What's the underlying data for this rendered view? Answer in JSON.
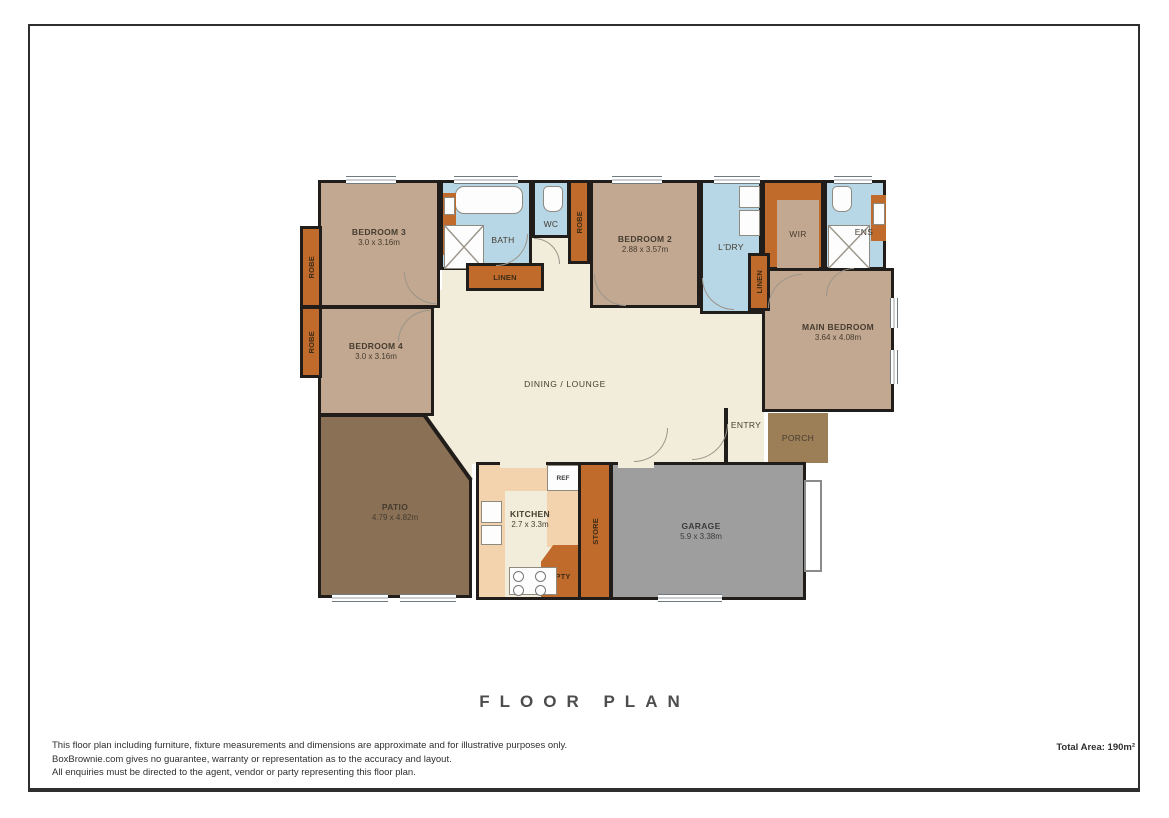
{
  "page": {
    "title": "FLOOR PLAN",
    "footer": {
      "disclaimer_line1": "This floor plan including furniture, fixture measurements and dimensions are approximate and for illustrative purposes only.",
      "disclaimer_line2": "BoxBrownie.com gives no guarantee, warranty or representation as to the accuracy and layout.",
      "disclaimer_line3": "All enquiries must be directed to the agent, vendor or party representing this floor plan.",
      "total_area": "Total Area: 190m²"
    }
  },
  "rooms": {
    "bedroom3": {
      "label": "BEDROOM 3",
      "dims": "3.0 x 3.16m"
    },
    "bedroom4": {
      "label": "BEDROOM 4",
      "dims": "3.0 x 3.16m"
    },
    "bedroom2": {
      "label": "BEDROOM 2",
      "dims": "2.88 x 3.57m"
    },
    "main_bedroom": {
      "label": "MAIN BEDROOM",
      "dims": "3.64 x 4.08m"
    },
    "bath": {
      "label": "BATH"
    },
    "wc": {
      "label": "WC"
    },
    "laundry": {
      "label": "L'DRY"
    },
    "wir": {
      "label": "WIR"
    },
    "ensuite": {
      "label": "ENS"
    },
    "dining_lounge": {
      "label": "DINING / LOUNGE"
    },
    "entry": {
      "label": "ENTRY"
    },
    "porch": {
      "label": "PORCH"
    },
    "patio": {
      "label": "PATIO",
      "dims": "4.79 x 4.82m"
    },
    "kitchen": {
      "label": "KITCHEN",
      "dims": "2.7 x 3.3m"
    },
    "garage": {
      "label": "GARAGE",
      "dims": "5.9 x 3.38m"
    },
    "linen_hall": {
      "label": "LINEN"
    },
    "linen_main": {
      "label": "LINEN"
    },
    "robe_bed3": {
      "label": "ROBE"
    },
    "robe_bed4": {
      "label": "ROBE"
    },
    "robe_bed2": {
      "label": "ROBE"
    },
    "fridge": {
      "label": "REF"
    },
    "store": {
      "label": "STORE"
    },
    "pantry": {
      "label": "PTY"
    }
  },
  "colors": {
    "wall": "#211d1a",
    "tan": "#c2a890",
    "blue": "#b7d6e6",
    "cream": "#f2ecda",
    "peach": "#f3d2ae",
    "orange": "#c06a2c",
    "patio": "#8a7055",
    "porch": "#9c7e57",
    "garage": "#9e9e9e",
    "ink": "#463c30"
  }
}
